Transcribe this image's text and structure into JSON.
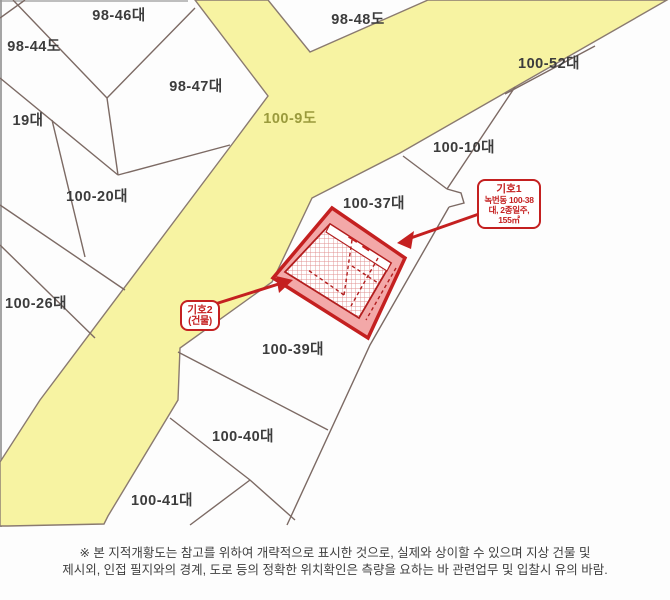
{
  "map": {
    "road_label": "100-9도",
    "parcels": [
      {
        "label": "98-46대"
      },
      {
        "label": "98-44도"
      },
      {
        "label": "98-48도"
      },
      {
        "label": "100-52대"
      },
      {
        "label": "98-47대"
      },
      {
        "label": "19대"
      },
      {
        "label": "100-10대"
      },
      {
        "label": "100-20대"
      },
      {
        "label": "100-37대"
      },
      {
        "label": "100-26대"
      },
      {
        "label": "100-39대"
      },
      {
        "label": "100-40대"
      },
      {
        "label": "100-41대"
      }
    ],
    "annotations": {
      "marker1": {
        "title": "기호1",
        "line1": "녹번동 100-38",
        "line2": "대, 2종일주,",
        "line3": "155㎡"
      },
      "marker2": {
        "title": "기호2",
        "line1": "(건물)"
      }
    },
    "colors": {
      "road_fill": "#f7f3a2",
      "boundary_line": "#7c6a64",
      "highlight_fill": "#f3a8a8",
      "highlight_border": "#c42020",
      "annotation_red": "#c42020"
    }
  },
  "footer": {
    "line1": "※ 본 지적개황도는 참고를 위하여 개략적으로 표시한 것으로, 실제와 상이할 수 있으며 지상 건물 및",
    "line2": "제시외, 인접 필지와의 경계, 도로 등의 정확한 위치확인은 측량을 요하는 바 관련업무 및 입찰시 유의 바람."
  }
}
